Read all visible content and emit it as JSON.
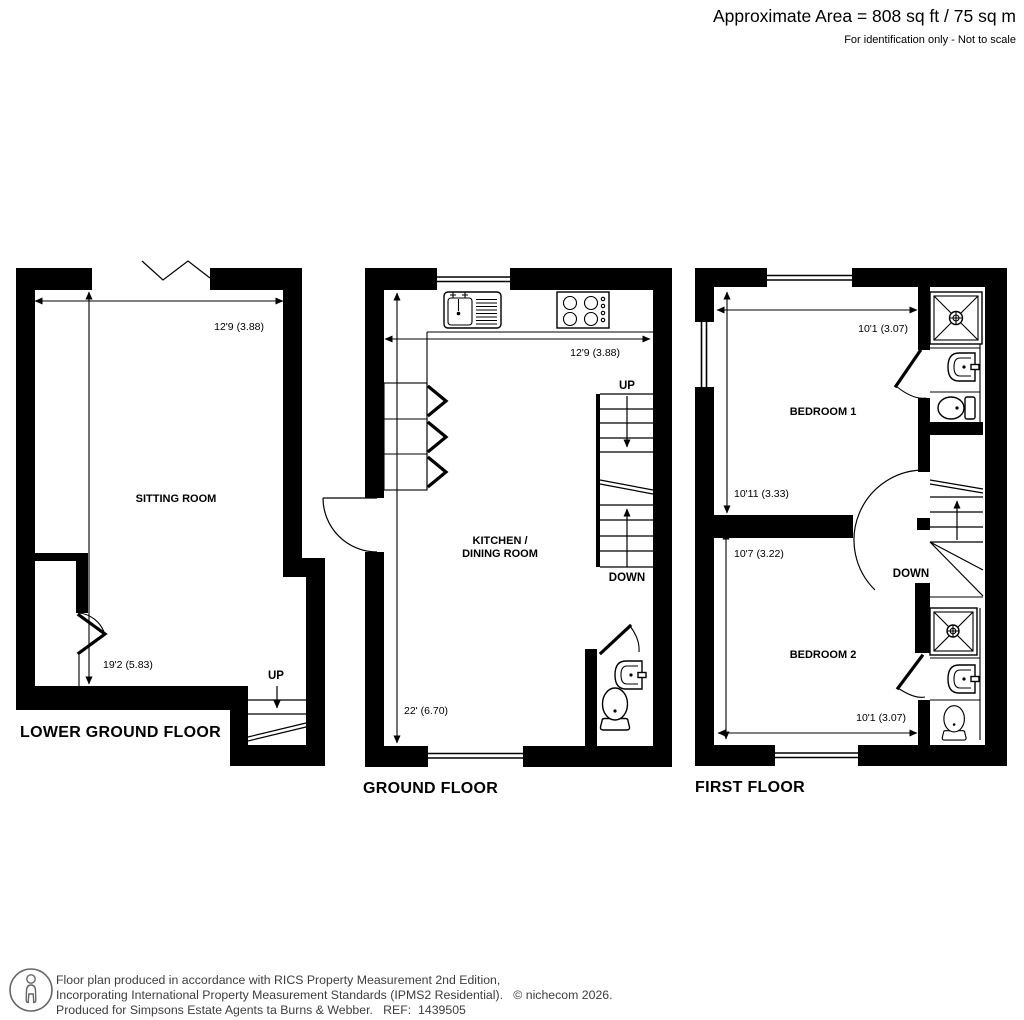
{
  "header": {
    "area": "Approximate Area = 808 sq ft / 75 sq m",
    "note": "For identification only - Not to scale"
  },
  "floors": {
    "lower_ground": {
      "label": "LOWER GROUND FLOOR",
      "room": "SITTING ROOM",
      "width": "12'9 (3.88)",
      "depth": "19'2 (5.83)",
      "up": "UP"
    },
    "ground": {
      "label": "GROUND FLOOR",
      "room_line1": "KITCHEN /",
      "room_line2": "DINING ROOM",
      "width": "12'9 (3.88)",
      "depth": "22' (6.70)",
      "up": "UP",
      "down": "DOWN"
    },
    "first": {
      "label": "FIRST FLOOR",
      "bedroom1": "BEDROOM 1",
      "bedroom1_width": "10'1 (3.07)",
      "bedroom1_depth": "10'11 (3.33)",
      "bedroom2": "BEDROOM 2",
      "bedroom2_width": "10'1 (3.07)",
      "bedroom2_depth": "10'7 (3.22)",
      "down": "DOWN"
    }
  },
  "footer": {
    "line1": "Floor plan produced in accordance with RICS Property Measurement 2nd Edition,",
    "line2": "Incorporating International Property Measurement Standards (IPMS2 Residential).   © nichecom 2026.",
    "line3": "Produced for Simpsons Estate Agents ta Burns & Webber.   REF:  1439505"
  },
  "colors": {
    "plan": "#000000",
    "footer_text": "#3d3d3d",
    "background": "#ffffff"
  }
}
